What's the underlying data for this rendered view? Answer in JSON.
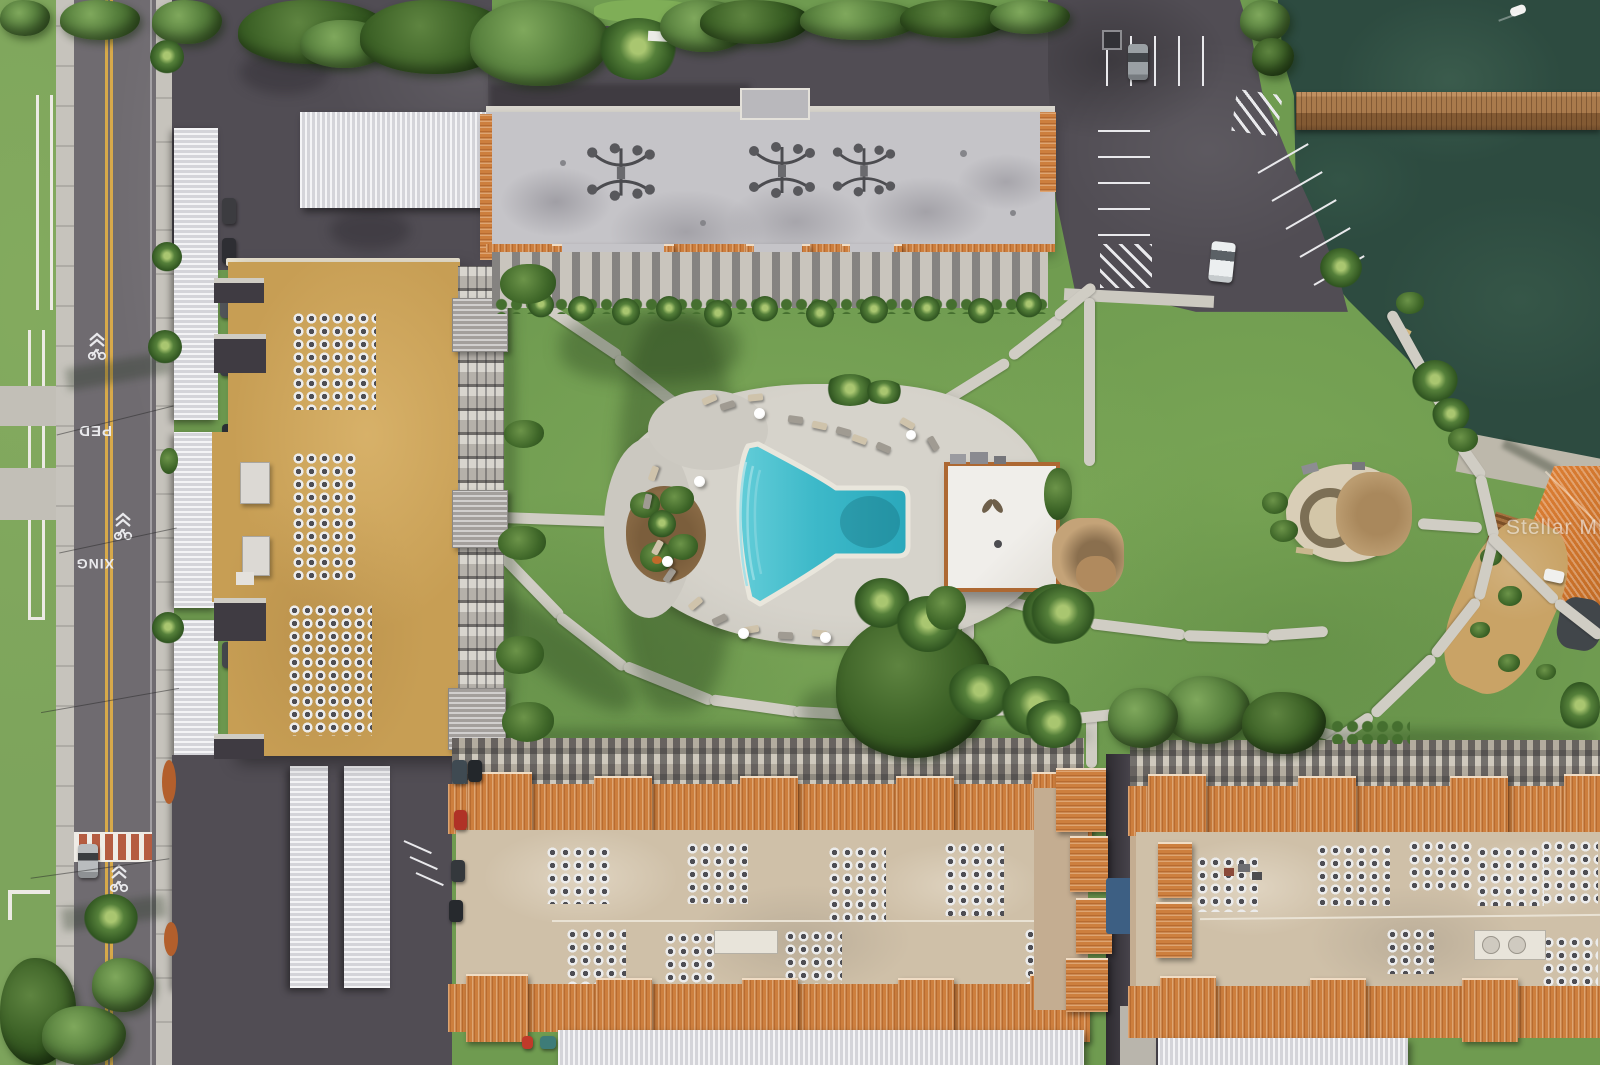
{
  "watermark": {
    "text": "Stellar MLS"
  },
  "road_markings": {
    "ped": "PED",
    "xing": "XING"
  },
  "colors": {
    "grass": "#6f9b50",
    "grass_dark": "#4e7a3c",
    "water": "#2d4b40",
    "pool_water": "#35b6c6",
    "pool_deck": "#cfccc4",
    "path": "#d0cdc4",
    "asphalt": "#514d54",
    "road": "#6f6b70",
    "sidewalk": "#c6c3bc",
    "roof_gray": "#c5c4c8",
    "roof_tan": "#c79e54",
    "roof_sand": "#cfc0a8",
    "mansard": "#cd7f3e",
    "carport": "#e9e9ec",
    "dock_wood": "#a97a4c",
    "yellow_line": "#d7a94a",
    "crosswalk_red": "#b55c41",
    "white_line": "#e9e9ec",
    "facade": "#b5b1aa"
  }
}
